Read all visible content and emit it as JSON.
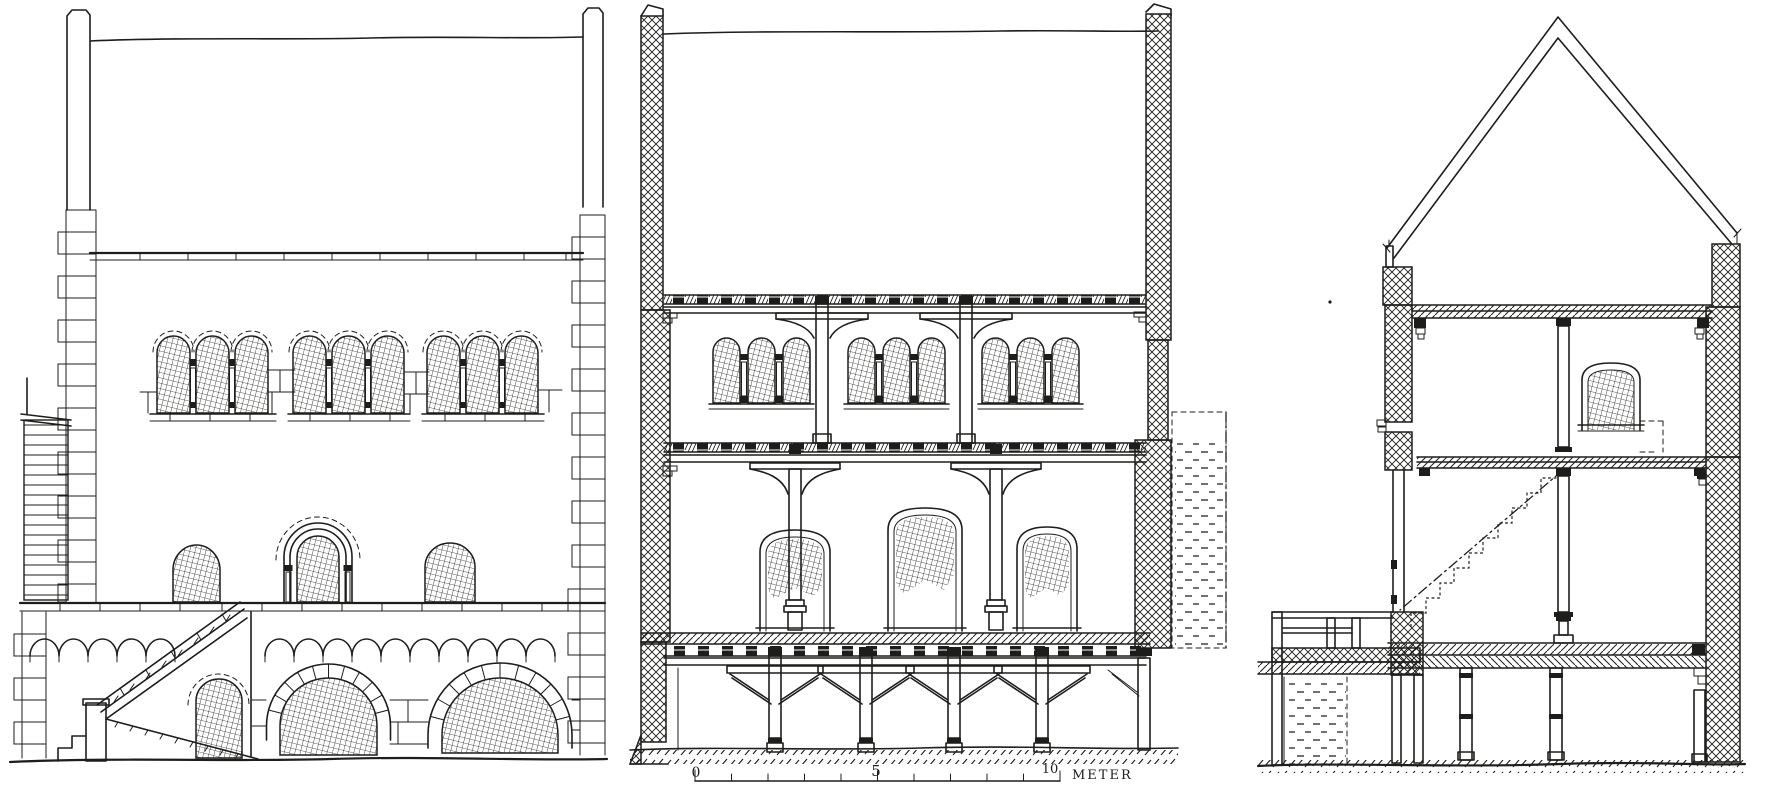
{
  "page": {
    "background_color": "#ffffff",
    "ink_color": "#1d1d1b"
  },
  "figure": {
    "kind": "architectural line drawing, three views of a romanesque stone house",
    "scale_bar": {
      "tick_0": "0",
      "tick_5": "5",
      "tick_10": "10",
      "unit_label": "METER"
    }
  }
}
